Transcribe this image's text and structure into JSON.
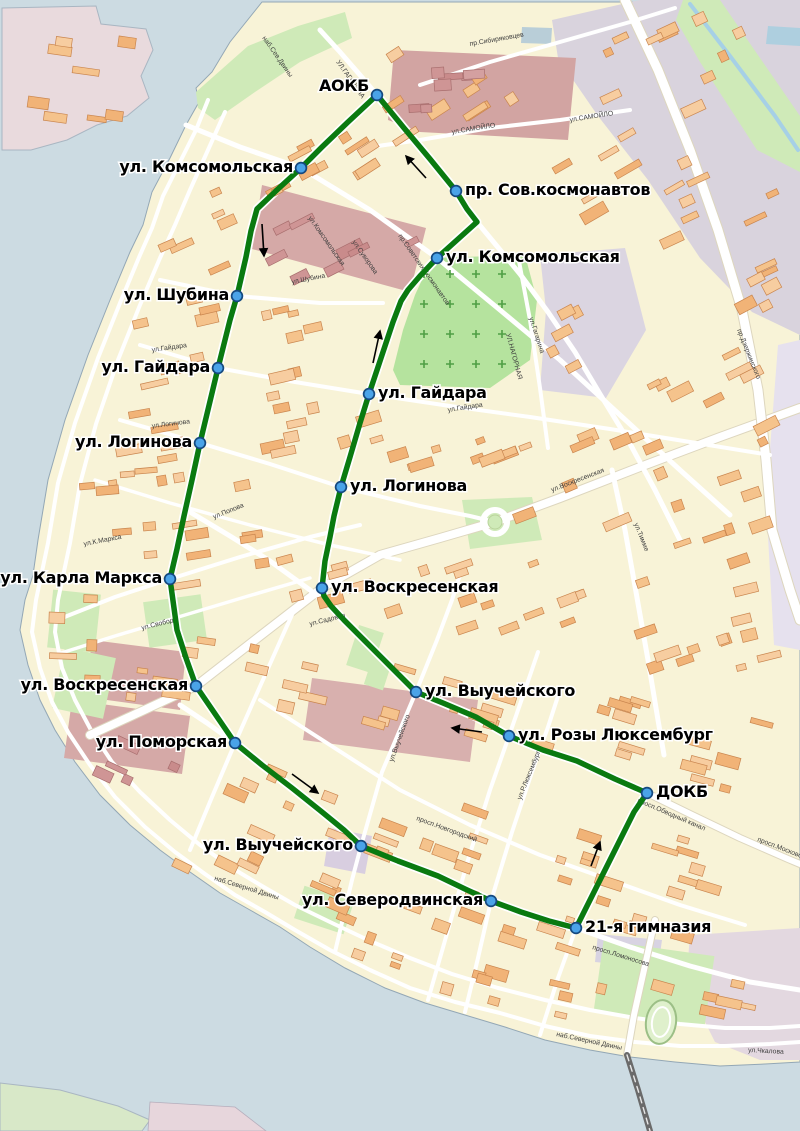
{
  "map": {
    "kind": "bus-route-map",
    "city_features": {
      "river_side": "water on west, south and north-east edges",
      "route_shape": "closed loop"
    }
  },
  "colors": {
    "route_line": "#0a7a10",
    "stop_fill": "#4aa3e8",
    "stop_stroke": "#15497f",
    "water": "#ccdbe2",
    "land": "#f8f3d7",
    "park": "#cfeab8",
    "cemetery": "#b5e39e",
    "industrial_mauve": "#d5a9a7",
    "industrial_gray": "#d9d3dd",
    "building": "#f4c08a",
    "label_text": "#000000"
  },
  "route": {
    "points": [
      [
        377,
        95
      ],
      [
        348,
        122
      ],
      [
        322,
        147
      ],
      [
        301,
        168
      ],
      [
        278,
        189
      ],
      [
        257,
        209
      ],
      [
        251,
        231
      ],
      [
        246,
        257
      ],
      [
        240,
        283
      ],
      [
        237,
        296
      ],
      [
        230,
        320
      ],
      [
        224,
        344
      ],
      [
        218,
        368
      ],
      [
        212,
        393
      ],
      [
        206,
        418
      ],
      [
        200,
        443
      ],
      [
        192,
        480
      ],
      [
        184,
        516
      ],
      [
        177,
        549
      ],
      [
        170,
        579
      ],
      [
        174,
        608
      ],
      [
        177,
        630
      ],
      [
        186,
        658
      ],
      [
        196,
        686
      ],
      [
        235,
        743
      ],
      [
        262,
        765
      ],
      [
        292,
        788
      ],
      [
        322,
        812
      ],
      [
        344,
        830
      ],
      [
        361,
        846
      ],
      [
        398,
        861
      ],
      [
        438,
        876
      ],
      [
        465,
        889
      ],
      [
        491,
        901
      ],
      [
        521,
        912
      ],
      [
        549,
        921
      ],
      [
        576,
        928
      ],
      [
        596,
        888
      ],
      [
        617,
        846
      ],
      [
        634,
        812
      ],
      [
        647,
        793
      ],
      [
        615,
        779
      ],
      [
        577,
        761
      ],
      [
        543,
        750
      ],
      [
        509,
        736
      ],
      [
        476,
        717
      ],
      [
        443,
        703
      ],
      [
        416,
        692
      ],
      [
        391,
        667
      ],
      [
        365,
        641
      ],
      [
        344,
        620
      ],
      [
        331,
        606
      ],
      [
        324,
        596
      ],
      [
        322,
        588
      ],
      [
        325,
        561
      ],
      [
        330,
        537
      ],
      [
        334,
        516
      ],
      [
        341,
        487
      ],
      [
        350,
        457
      ],
      [
        360,
        423
      ],
      [
        369,
        394
      ],
      [
        381,
        358
      ],
      [
        393,
        322
      ],
      [
        401,
        301
      ],
      [
        408,
        290
      ],
      [
        420,
        276
      ],
      [
        437,
        258
      ],
      [
        457,
        240
      ],
      [
        477,
        222
      ],
      [
        467,
        209
      ],
      [
        456,
        191
      ],
      [
        430,
        159
      ],
      [
        404,
        128
      ],
      [
        377,
        95
      ]
    ]
  },
  "stops": [
    {
      "name": "АОКБ",
      "x": 377,
      "y": 95,
      "side": "end"
    },
    {
      "name": "ул. Комсомольская",
      "x": 301,
      "y": 168,
      "side": "end"
    },
    {
      "name": "пр. Сов.космонавтов",
      "x": 456,
      "y": 191,
      "side": "start"
    },
    {
      "name": "ул. Комсомольская",
      "x": 437,
      "y": 258,
      "side": "start"
    },
    {
      "name": "ул. Шубина",
      "x": 237,
      "y": 296,
      "side": "end"
    },
    {
      "name": "ул. Гайдара",
      "x": 218,
      "y": 368,
      "side": "end"
    },
    {
      "name": "ул. Гайдара",
      "x": 369,
      "y": 394,
      "side": "start"
    },
    {
      "name": "ул. Логинова",
      "x": 200,
      "y": 443,
      "side": "end"
    },
    {
      "name": "ул. Логинова",
      "x": 341,
      "y": 487,
      "side": "start"
    },
    {
      "name": "ул. Карла Маркса",
      "x": 170,
      "y": 579,
      "side": "end"
    },
    {
      "name": "ул. Воскресенская",
      "x": 322,
      "y": 588,
      "side": "start"
    },
    {
      "name": "ул. Воскресенская",
      "x": 196,
      "y": 686,
      "side": "end"
    },
    {
      "name": "ул. Выучейского",
      "x": 416,
      "y": 692,
      "side": "start"
    },
    {
      "name": "ул. Поморская",
      "x": 235,
      "y": 743,
      "side": "end"
    },
    {
      "name": "ул. Розы Люксембург",
      "x": 509,
      "y": 736,
      "side": "start"
    },
    {
      "name": "ДОКБ",
      "x": 647,
      "y": 793,
      "side": "start"
    },
    {
      "name": "ул. Выучейского",
      "x": 361,
      "y": 846,
      "side": "end"
    },
    {
      "name": "ул. Северодвинская",
      "x": 491,
      "y": 901,
      "side": "end"
    },
    {
      "name": "21-я гимназия",
      "x": 576,
      "y": 928,
      "side": "start"
    }
  ],
  "direction_arrows": [
    {
      "x1": 426,
      "y1": 178,
      "x2": 406,
      "y2": 156
    },
    {
      "x1": 262,
      "y1": 224,
      "x2": 264,
      "y2": 256
    },
    {
      "x1": 373,
      "y1": 363,
      "x2": 380,
      "y2": 331
    },
    {
      "x1": 292,
      "y1": 774,
      "x2": 318,
      "y2": 793
    },
    {
      "x1": 482,
      "y1": 732,
      "x2": 452,
      "y2": 728
    },
    {
      "x1": 591,
      "y1": 866,
      "x2": 600,
      "y2": 842
    }
  ],
  "street_labels": [
    {
      "t": "наб.Сев.Двины",
      "x": 262,
      "y": 38,
      "r": 55
    },
    {
      "t": "УЛ.ГАГАРИНА",
      "x": 336,
      "y": 62,
      "r": 55
    },
    {
      "t": "пр.Сибиряковцев",
      "x": 470,
      "y": 46,
      "r": -10
    },
    {
      "t": "ул.САМОЙЛО",
      "x": 452,
      "y": 134,
      "r": -9
    },
    {
      "t": "ул.САМОЙЛО",
      "x": 570,
      "y": 122,
      "r": -9
    },
    {
      "t": "пр.Советских Космонавтов",
      "x": 398,
      "y": 236,
      "r": 55
    },
    {
      "t": "ул.Комсомольская",
      "x": 308,
      "y": 218,
      "r": 55
    },
    {
      "t": "ул.Суворова",
      "x": 352,
      "y": 242,
      "r": 55
    },
    {
      "t": "ул.Гагарина",
      "x": 529,
      "y": 318,
      "r": 72
    },
    {
      "t": "УЛ.НАГОРНАЯ",
      "x": 506,
      "y": 334,
      "r": 75
    },
    {
      "t": "ул.Шубина",
      "x": 292,
      "y": 284,
      "r": -11
    },
    {
      "t": "ул.Гайдара",
      "x": 152,
      "y": 352,
      "r": -8
    },
    {
      "t": "ул.Гайдара",
      "x": 448,
      "y": 412,
      "r": -9
    },
    {
      "t": "ул.Логинова",
      "x": 152,
      "y": 428,
      "r": -7
    },
    {
      "t": "ул.Попова",
      "x": 214,
      "y": 519,
      "r": -22
    },
    {
      "t": "ул.К.Маркса",
      "x": 84,
      "y": 546,
      "r": -11
    },
    {
      "t": "ул.Свободы",
      "x": 142,
      "y": 630,
      "r": -14
    },
    {
      "t": "ул.Садовая",
      "x": 310,
      "y": 626,
      "r": -14
    },
    {
      "t": "ул.Воскресенская",
      "x": 552,
      "y": 492,
      "r": -21
    },
    {
      "t": "ул.Тимме",
      "x": 634,
      "y": 524,
      "r": 68
    },
    {
      "t": "пр.Дзержинского",
      "x": 737,
      "y": 330,
      "r": 68
    },
    {
      "t": "ул.Выучейского",
      "x": 393,
      "y": 762,
      "r": -70
    },
    {
      "t": "ул.Р.Люксембург",
      "x": 521,
      "y": 800,
      "r": -68
    },
    {
      "t": "просп.Новгородский",
      "x": 416,
      "y": 820,
      "r": 20
    },
    {
      "t": "просп.Обводный канал",
      "x": 637,
      "y": 802,
      "r": 23
    },
    {
      "t": "просп.Московский",
      "x": 757,
      "y": 841,
      "r": 21
    },
    {
      "t": "просп.Ломоносова",
      "x": 592,
      "y": 949,
      "r": 17
    },
    {
      "t": "наб.Северной Двины",
      "x": 214,
      "y": 880,
      "r": 17
    },
    {
      "t": "наб.Северной Двины",
      "x": 556,
      "y": 1036,
      "r": 12
    },
    {
      "t": "ул.Чкалова",
      "x": 748,
      "y": 1052,
      "r": 3
    }
  ]
}
